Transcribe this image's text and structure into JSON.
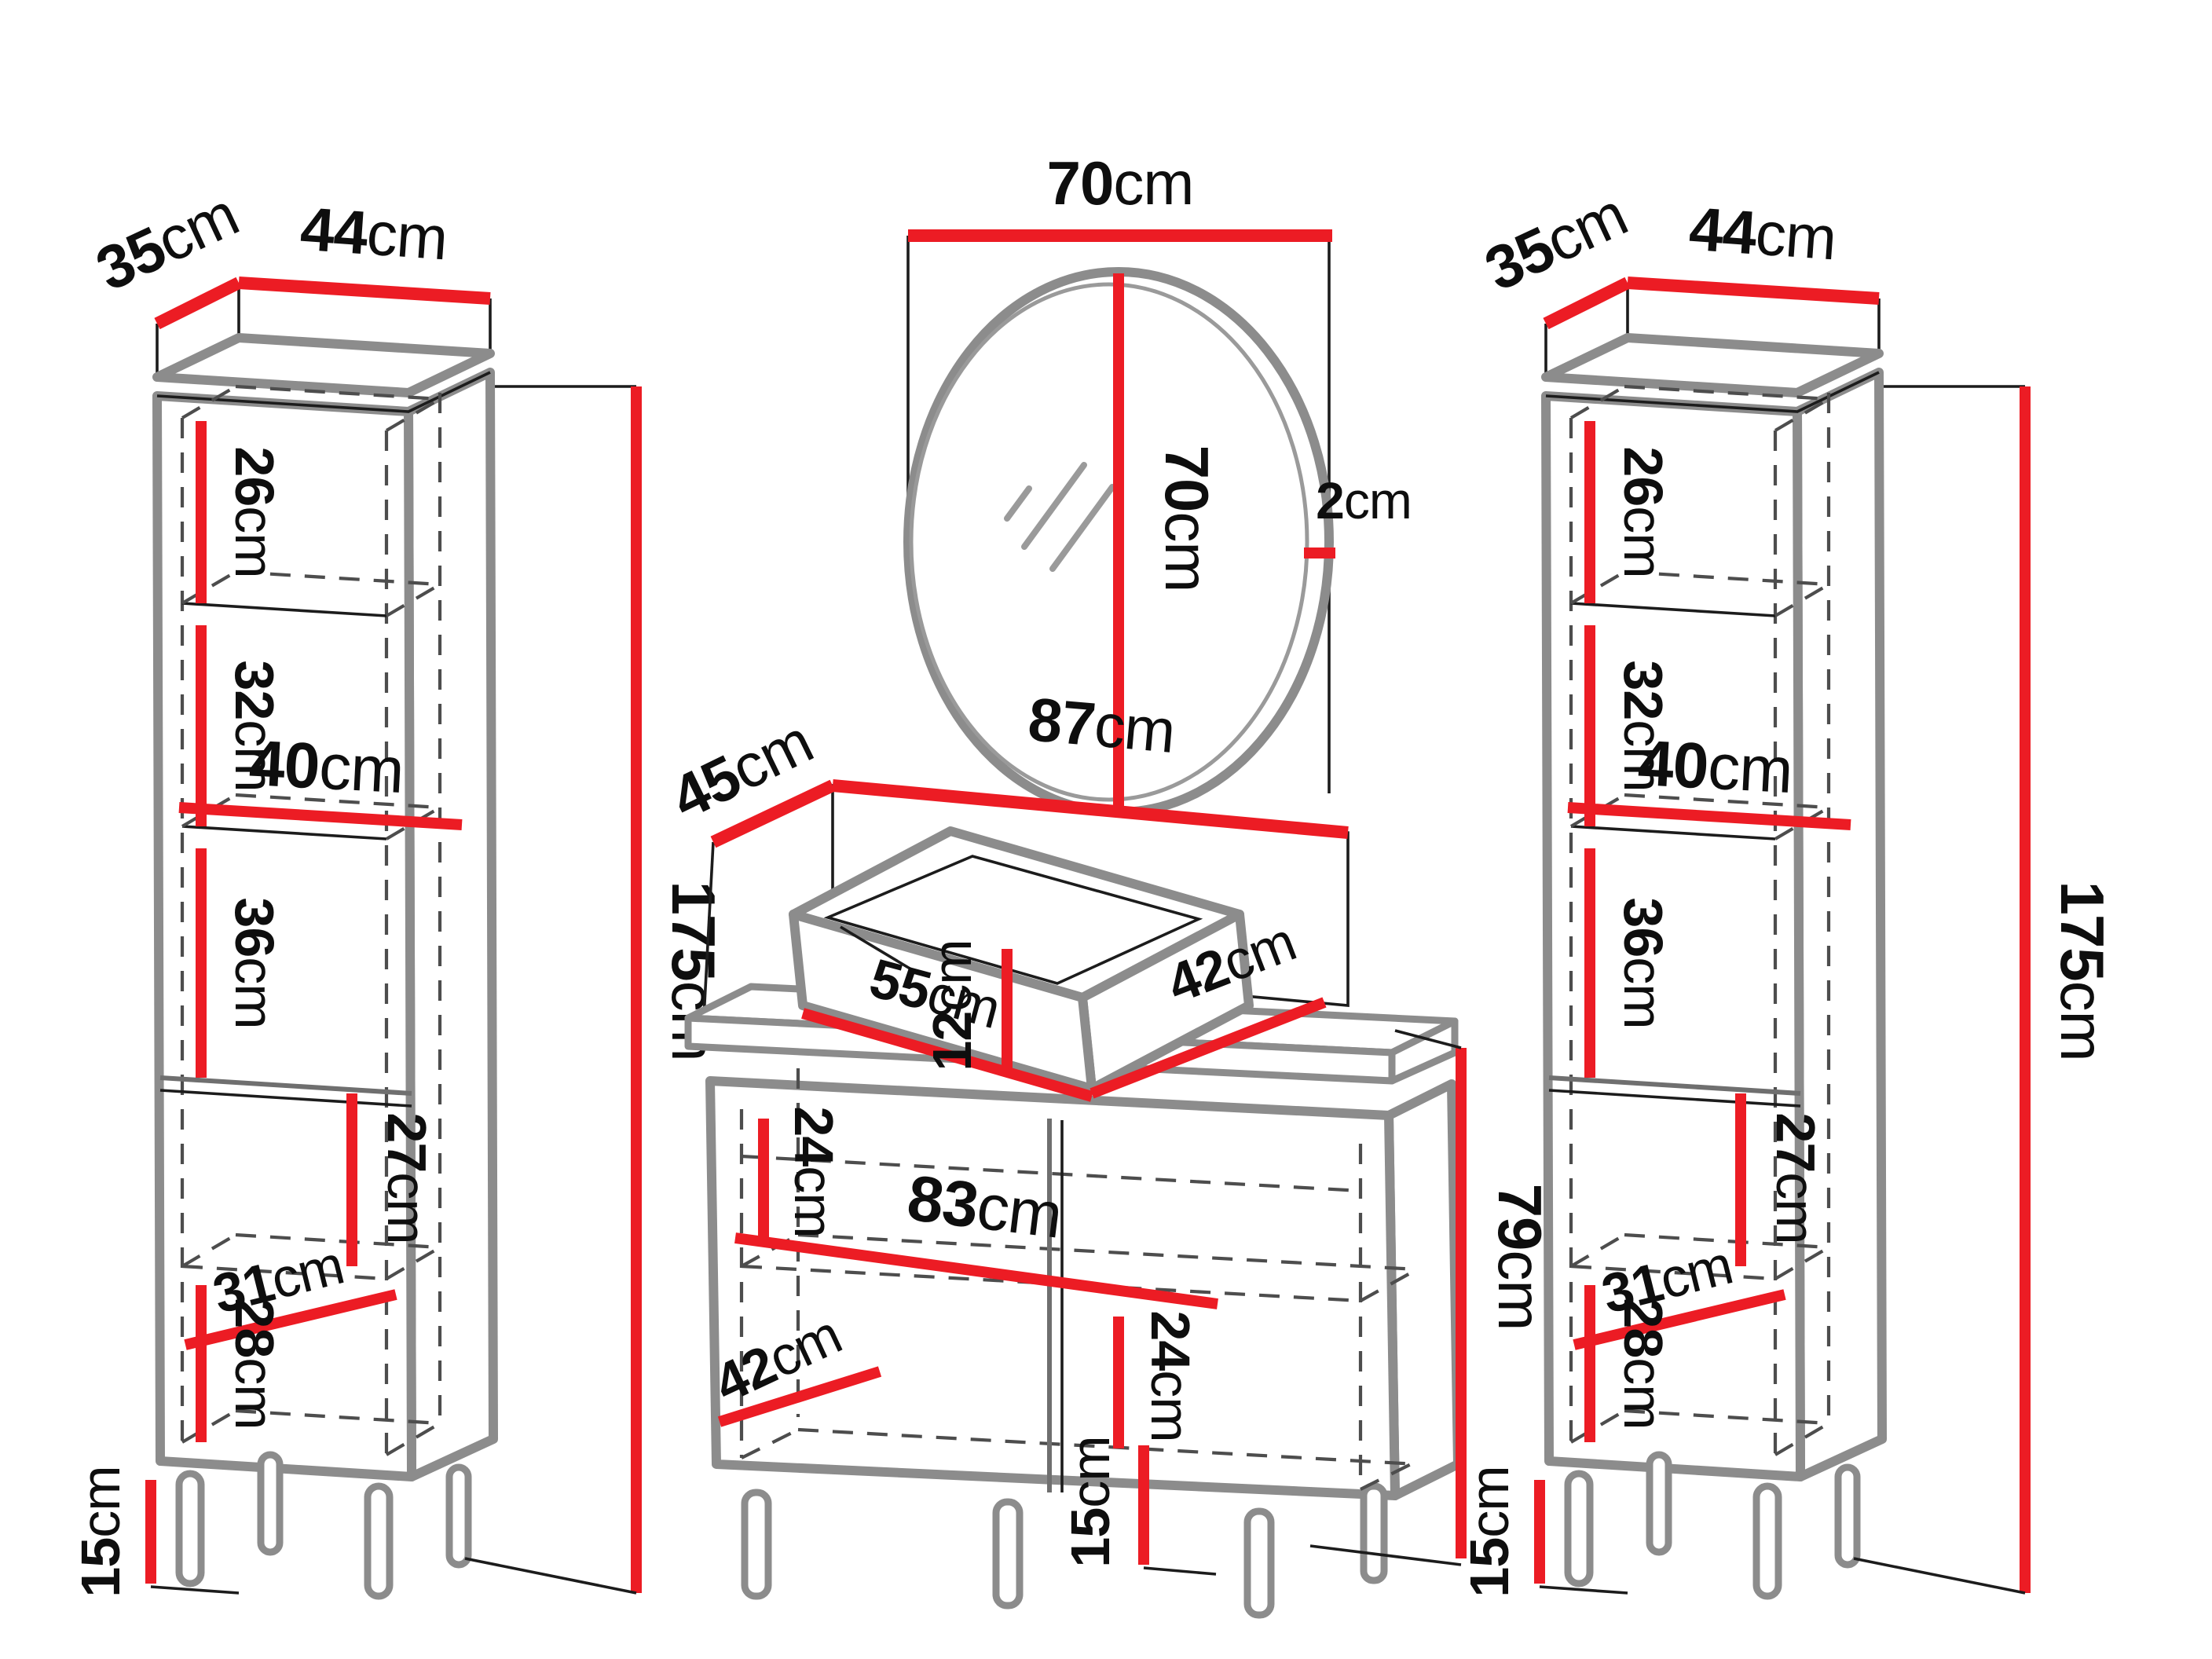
{
  "diagram_title": "Bathroom furniture set dimension diagram",
  "unit": "cm",
  "colors": {
    "dimension_red": "#EC1C24",
    "outline_gray": "#8C8C8C",
    "text_black": "#0e0e0e"
  },
  "left_cabinet": {
    "depth": {
      "value": "35",
      "unit": "cm"
    },
    "width": {
      "value": "44",
      "unit": "cm"
    },
    "height": {
      "value": "175",
      "unit": "cm"
    },
    "section_1": {
      "value": "26",
      "unit": "cm"
    },
    "section_2": {
      "value": "32",
      "unit": "cm"
    },
    "shelf_width": {
      "value": "40",
      "unit": "cm"
    },
    "section_3": {
      "value": "36",
      "unit": "cm"
    },
    "door_section": {
      "value": "27",
      "unit": "cm"
    },
    "door_shelf_width": {
      "value": "31",
      "unit": "cm"
    },
    "door_bottom_section": {
      "value": "28",
      "unit": "cm"
    },
    "leg_height": {
      "value": "15",
      "unit": "cm"
    }
  },
  "mirror": {
    "width": {
      "value": "70",
      "unit": "cm"
    },
    "height": {
      "value": "70",
      "unit": "cm"
    },
    "frame_thickness": {
      "value": "2",
      "unit": "cm"
    }
  },
  "vanity": {
    "depth": {
      "value": "45",
      "unit": "cm"
    },
    "width": {
      "value": "87",
      "unit": "cm"
    },
    "height": {
      "value": "79",
      "unit": "cm"
    },
    "leg_height": {
      "value": "15",
      "unit": "cm"
    },
    "sink": {
      "width": {
        "value": "55",
        "unit": "cm"
      },
      "height": {
        "value": "12",
        "unit": "cm"
      },
      "depth": {
        "value": "42",
        "unit": "cm"
      }
    },
    "interior": {
      "left_section": {
        "value": "24",
        "unit": "cm"
      },
      "shelf_width": {
        "value": "83",
        "unit": "cm"
      },
      "right_section": {
        "value": "24",
        "unit": "cm"
      },
      "bottom_width": {
        "value": "42",
        "unit": "cm"
      }
    }
  },
  "right_cabinet": {
    "depth": {
      "value": "35",
      "unit": "cm"
    },
    "width": {
      "value": "44",
      "unit": "cm"
    },
    "height": {
      "value": "175",
      "unit": "cm"
    },
    "section_1": {
      "value": "26",
      "unit": "cm"
    },
    "section_2": {
      "value": "32",
      "unit": "cm"
    },
    "shelf_width": {
      "value": "40",
      "unit": "cm"
    },
    "section_3": {
      "value": "36",
      "unit": "cm"
    },
    "door_section": {
      "value": "27",
      "unit": "cm"
    },
    "door_shelf_width": {
      "value": "31",
      "unit": "cm"
    },
    "door_bottom_section": {
      "value": "28",
      "unit": "cm"
    },
    "leg_height": {
      "value": "15",
      "unit": "cm"
    }
  }
}
